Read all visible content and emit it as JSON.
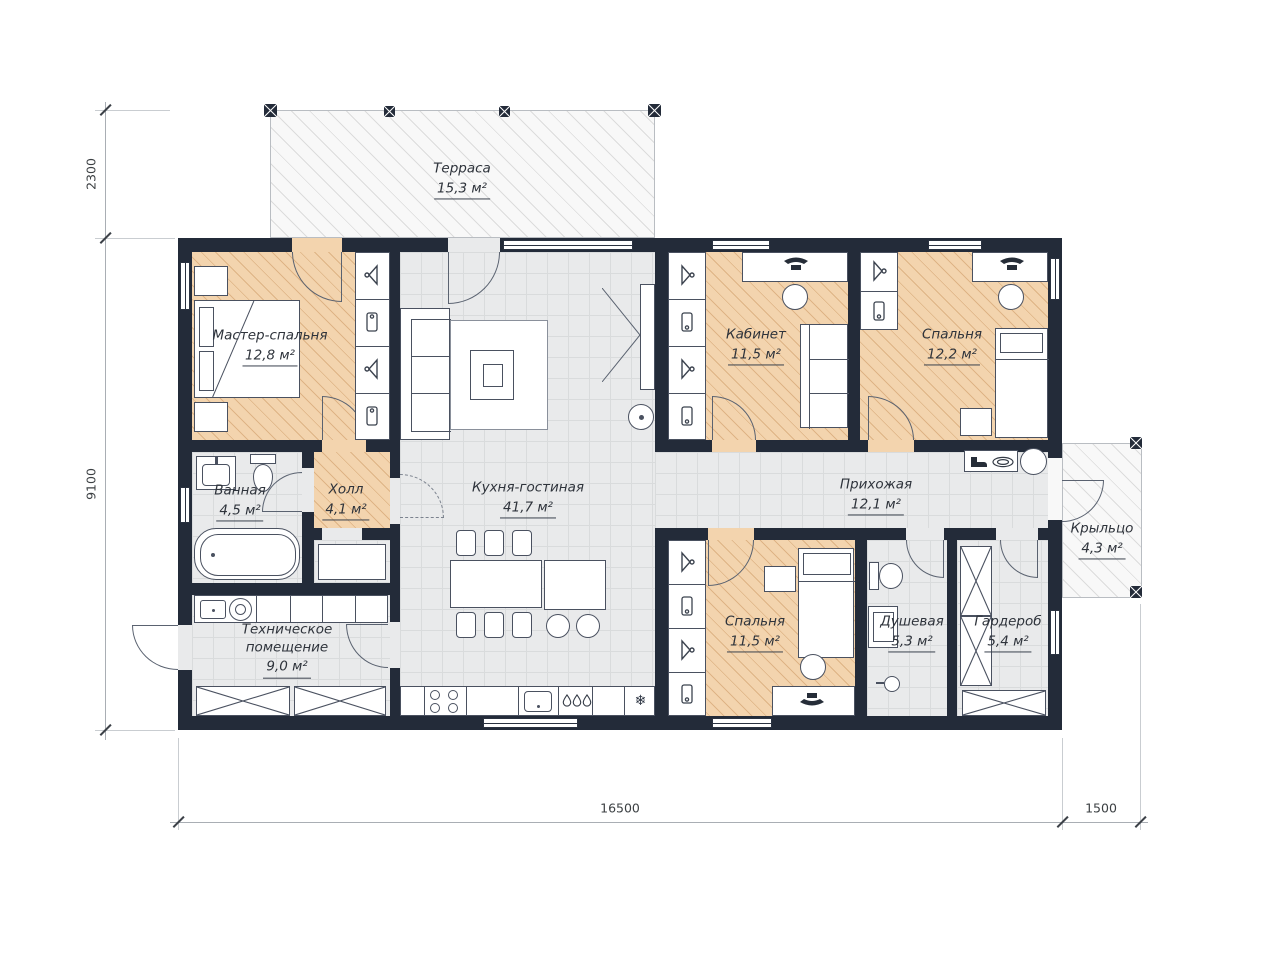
{
  "rooms": [
    {
      "name": "Терраса",
      "area": "15,3 м²"
    },
    {
      "name": "Мастер-спальня",
      "area": "12,8 м²"
    },
    {
      "name": "Кабинет",
      "area": "11,5 м²"
    },
    {
      "name": "Спальня",
      "area": "12,2 м²"
    },
    {
      "name": "Ванная",
      "area": "4,5 м²"
    },
    {
      "name": "Холл",
      "area": "4,1 м²"
    },
    {
      "name": "Кухня-гостиная",
      "area": "41,7 м²"
    },
    {
      "name": "Прихожая",
      "area": "12,1 м²"
    },
    {
      "name": "Техническое помещение",
      "area": "9,0 м²"
    },
    {
      "name": "Спальня",
      "area": "11,5 м²"
    },
    {
      "name": "Душевая",
      "area": "5,3 м²"
    },
    {
      "name": "Гардероб",
      "area": "5,4 м²"
    },
    {
      "name": "Крыльцо",
      "area": "4,3 м²"
    }
  ],
  "dimensions": {
    "terrace_depth": "2300",
    "house_depth": "9100",
    "house_length": "16500",
    "porch_width": "1500"
  },
  "icons": {
    "snowflake": "❄"
  },
  "colors": {
    "wall": "#232b39",
    "bedroom_floor": "#f3d4ae",
    "common_floor": "#e9eaeb",
    "deck": "#f8f8f8"
  }
}
